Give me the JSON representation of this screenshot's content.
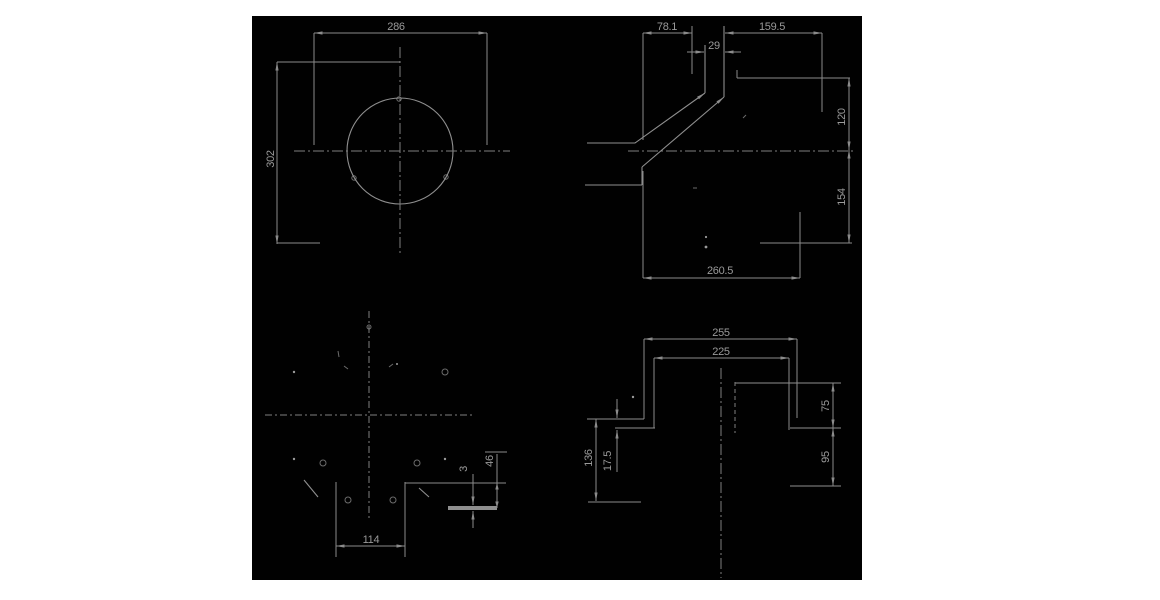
{
  "canvas": {
    "page_background": "#ffffff",
    "panel_background": "#010101",
    "line_color": "#8b8b8b",
    "centerline_color": "#7e7e7e",
    "text_color": "#9a9a9a"
  },
  "views": {
    "front": {
      "dim_width": "286",
      "dim_height": "302"
    },
    "side": {
      "dim_offset": "78.1",
      "dim_tube_width": "29",
      "dim_reach": "159.5",
      "dim_above_axis": "120",
      "dim_below_axis": "154",
      "dim_total_run": "260.5"
    },
    "plate_detail": {
      "dim_slot_width": "114",
      "dim_plate_thickness": "3",
      "dim_depth": "46"
    },
    "bracket_profile": {
      "dim_outer_width": "255",
      "dim_inner_width": "225",
      "dim_upper_height": "75",
      "dim_lower_height": "95",
      "dim_left_height": "136",
      "dim_step": "17.5"
    }
  }
}
